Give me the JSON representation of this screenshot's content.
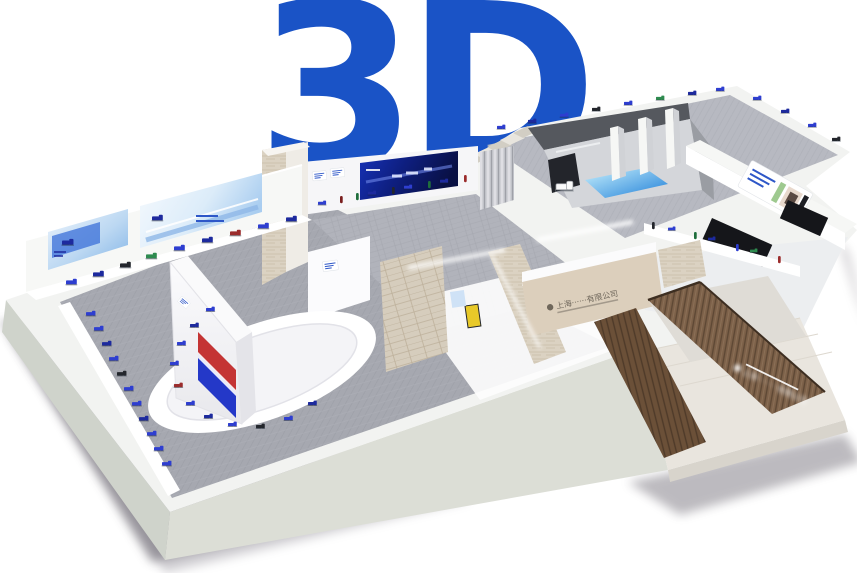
{
  "logo": {
    "text": "3D",
    "color": "#1A53C6"
  },
  "scene": {
    "type": "3d-exhibition-hall-overview",
    "view": "isometric",
    "background_color": "#ffffff"
  },
  "palette": {
    "wall_white": "#f3f4f2",
    "slab_face_left": "#cfd3cb",
    "slab_face_front": "#dcded6",
    "carpet_main": "#a6a8b0",
    "carpet_upper": "#b7b9c1",
    "travertine": "#dbd2c2",
    "wood": "#7d6149",
    "banner_dark_blue": "#10239b",
    "banner_light_blue": "#9fc6ee",
    "accent_blue": "#2e3ed0",
    "screen_red": "#c43434",
    "screen_blue": "#2438c8",
    "floor_decal_blue": "#2aa3e8"
  },
  "signs": {
    "entrance_company_sign": "上海······有限公司",
    "reception_company_sign": "上海·········有限公司"
  },
  "banners": {
    "main_hall_small": "light-blue truck banner",
    "main_hall_large": "light-blue slogan banner",
    "center_hall": "dark-blue truck banner",
    "corridor_poster": "photo poster"
  },
  "exhibits": {
    "main_hall_wall_trucks": 9,
    "main_hall_side_trucks": 11,
    "oval_platform_trucks": 11,
    "center_hall_shelf_items": 9,
    "pavilion_hall_trucks": 12,
    "corridor_shelf_items": 7,
    "pavilion_truck_display": 1
  }
}
